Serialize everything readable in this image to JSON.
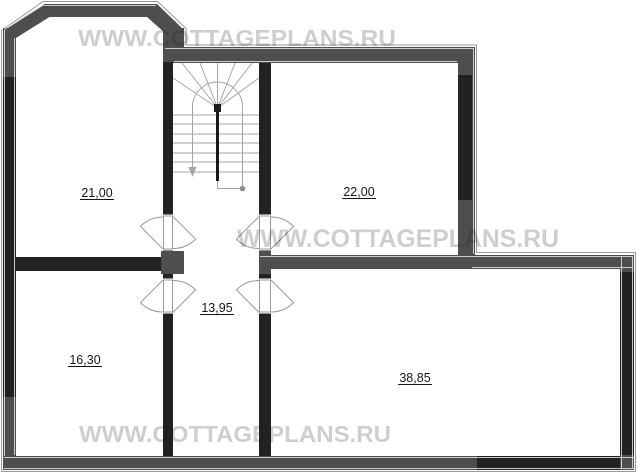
{
  "watermark": {
    "text": "WWW.COTTAGEPLANS.RU"
  },
  "rooms": [
    {
      "id": "room-upper-left",
      "area": "21,00"
    },
    {
      "id": "room-upper-right",
      "area": "22,00"
    },
    {
      "id": "hallway",
      "area": "13,95"
    },
    {
      "id": "room-lower-left",
      "area": "16,30"
    },
    {
      "id": "room-lower-right",
      "area": "38,85"
    }
  ],
  "colors": {
    "outer_wall": "#4e4e4e",
    "inner_wall": "#222222",
    "stair_line": "#a5a5a5",
    "door_line": "#999999",
    "label_text": "#161616",
    "watermark": "#cacaca"
  }
}
